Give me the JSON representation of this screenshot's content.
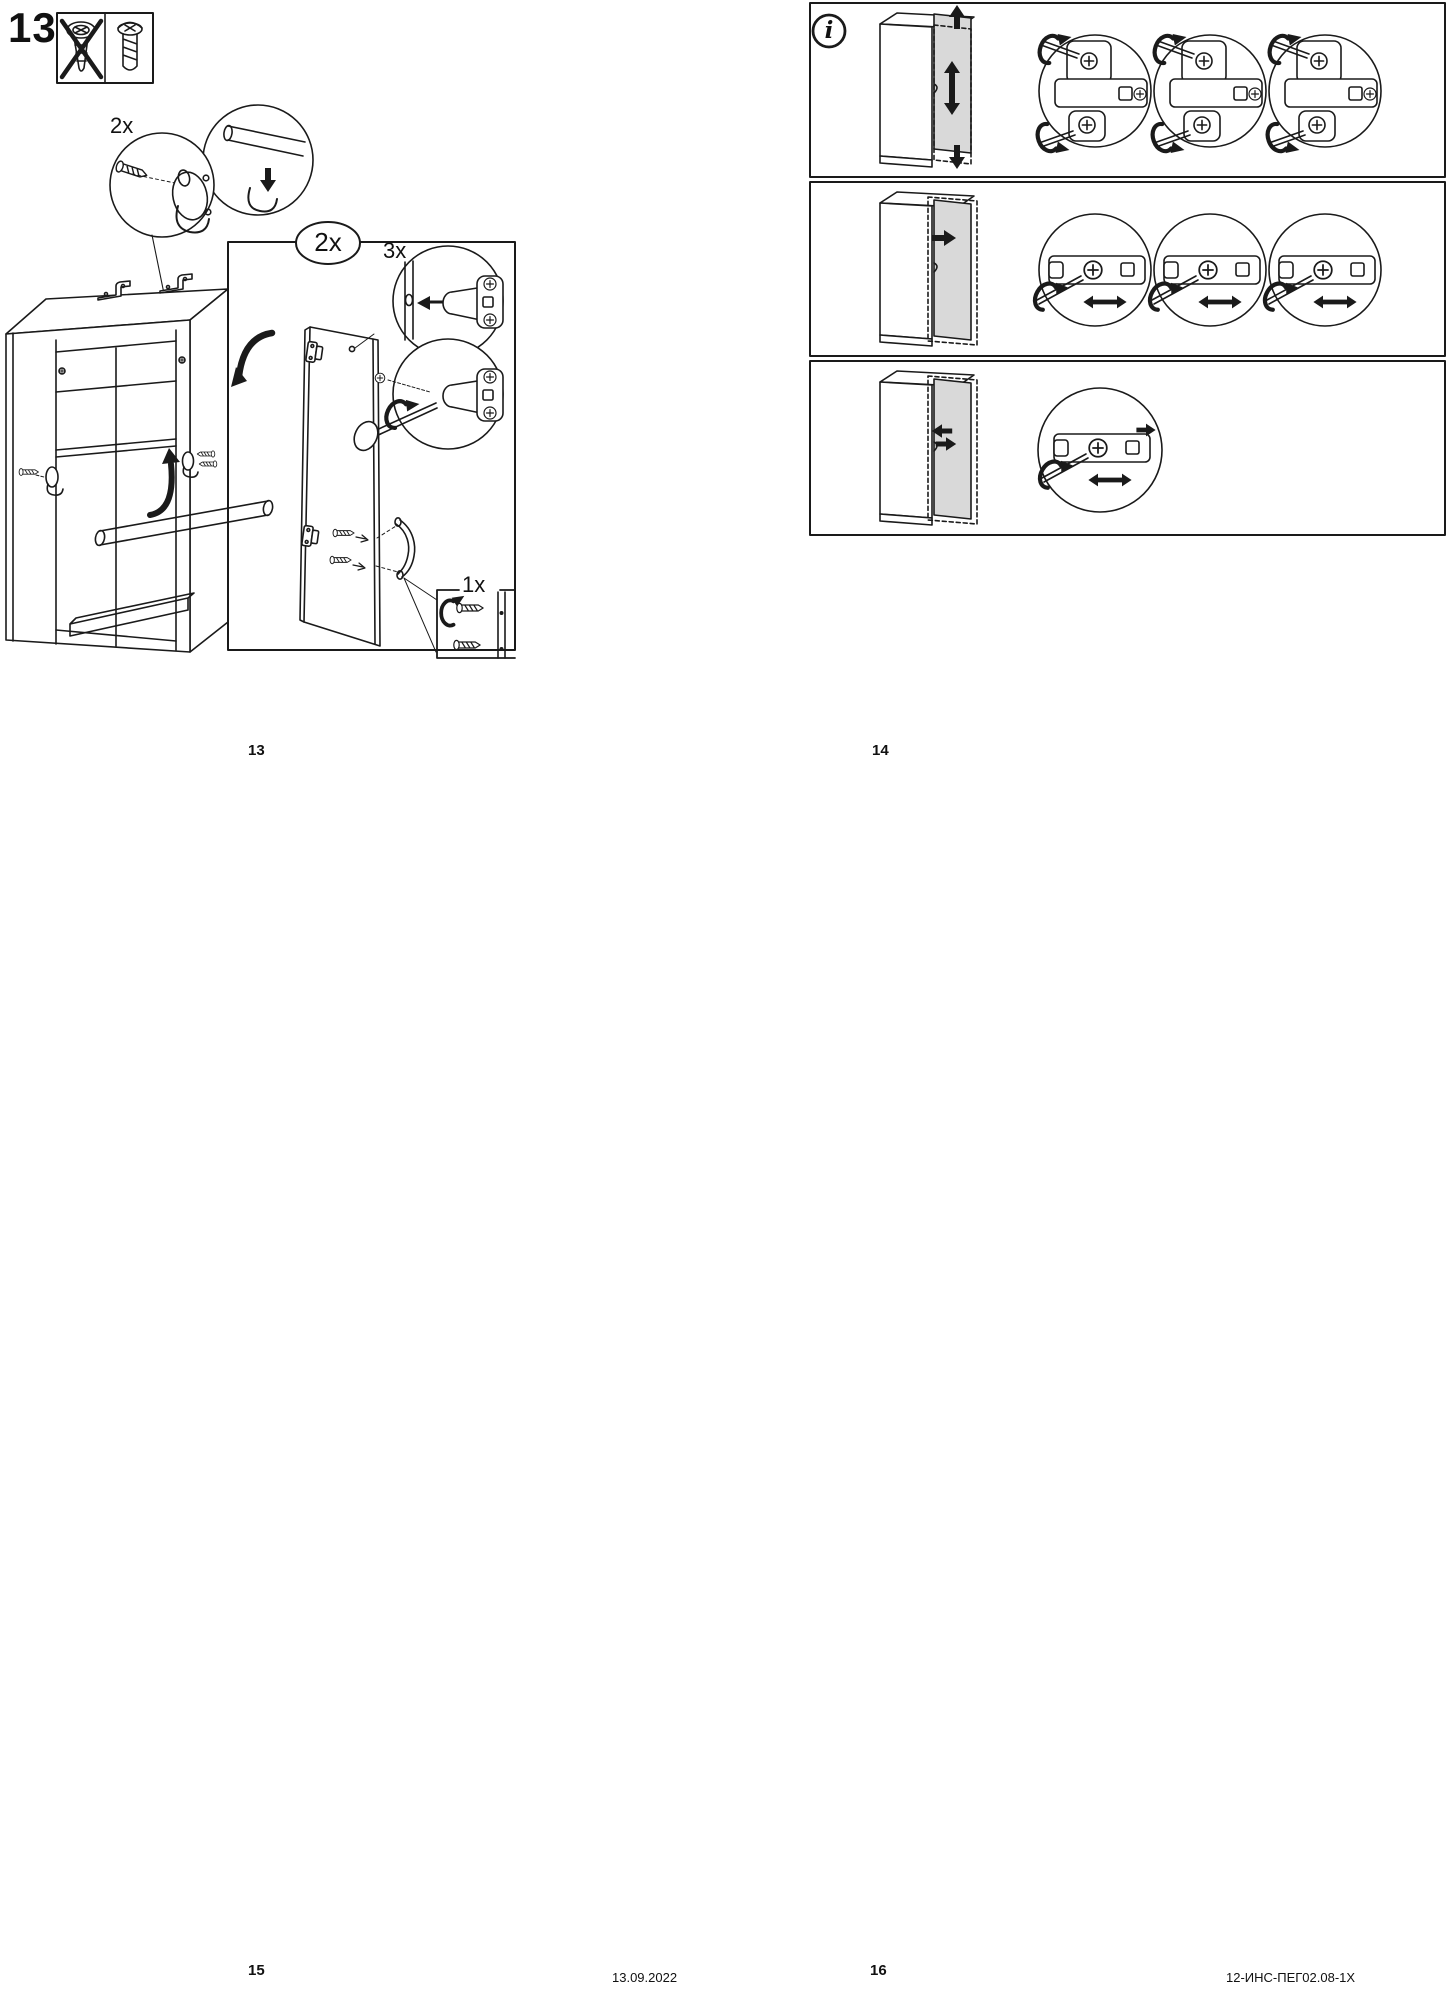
{
  "colors": {
    "ink": "#1a1a1a",
    "door_gray": "#d9d9d9"
  },
  "left_page": {
    "step_number": "13",
    "warning_box": {
      "wrong_icon": "countersunk-screw-crossed-out",
      "correct_icon": "pan-head-screw"
    },
    "labels": {
      "rail_holder_qty": "2x",
      "door_qty": "2x",
      "hinge_qty": "3x",
      "handle_screw_qty": "1x"
    },
    "page_number": "13"
  },
  "right_page": {
    "info_symbol": "i",
    "rows": [
      {
        "icon": "adjust-door-vertical"
      },
      {
        "icon": "adjust-door-horizontal"
      },
      {
        "icon": "adjust-door-depth"
      }
    ],
    "page_number": "14"
  },
  "footer": {
    "left_page_number": "15",
    "date": "13.09.2022",
    "right_page_number": "16",
    "document_code": "12-ИНС-ПЕГ02.08-1Х"
  }
}
